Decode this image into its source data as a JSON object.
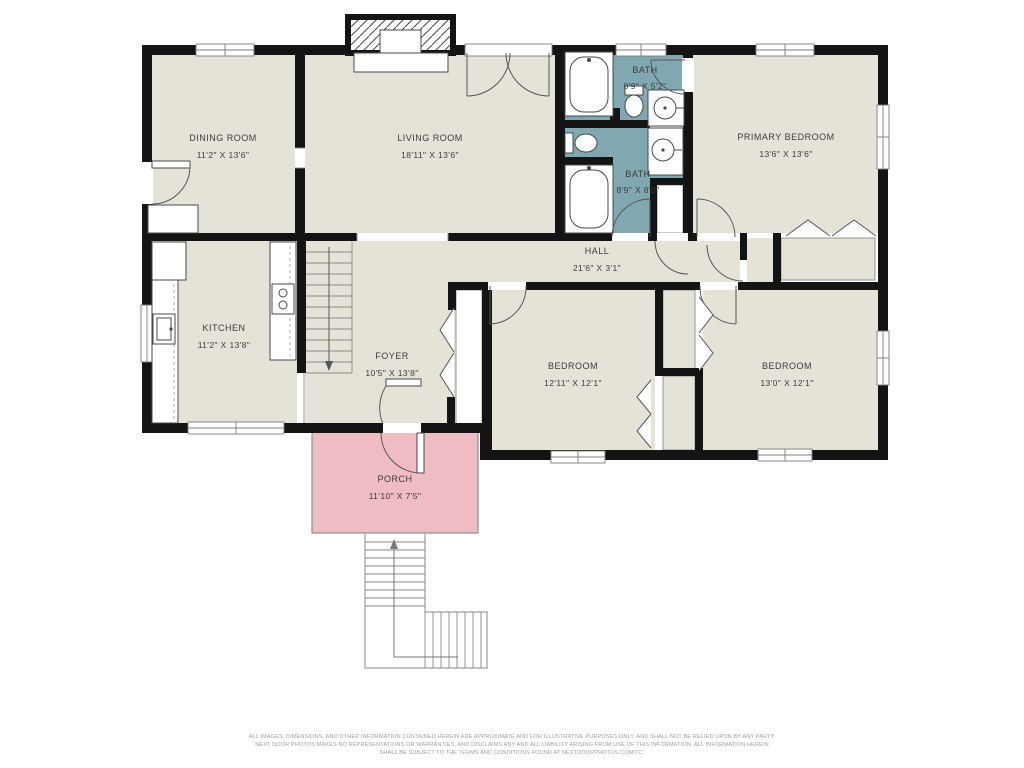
{
  "title": "single-story house floor plan",
  "colors": {
    "wall": "#141414",
    "floor": "#e5e3d7",
    "bath": "#7fa8b0",
    "porch": "#eebcc2",
    "background": "#ffffff",
    "text": "#3b3b3b",
    "disclaimer": "#a0a0a0"
  },
  "rooms": {
    "dining": {
      "name": "DINING ROOM",
      "dims": "11'2\" X 13'6\""
    },
    "living": {
      "name": "LIVING ROOM",
      "dims": "18'11\" X 13'6\""
    },
    "bath_top": {
      "name": "BATH",
      "dims": "8'9\" X 5'2\""
    },
    "bath_main": {
      "name": "BATH",
      "dims": "8'9\" X 8'0\""
    },
    "primary": {
      "name": "PRIMARY BEDROOM",
      "dims": "13'6\" X 13'6\""
    },
    "hall": {
      "name": "HALL",
      "dims": "21'6\" X 3'1\""
    },
    "kitchen": {
      "name": "KITCHEN",
      "dims": "11'2\" X 13'8\""
    },
    "foyer": {
      "name": "FOYER",
      "dims": "10'5\" X 13'8\""
    },
    "bedroom_left": {
      "name": "BEDROOM",
      "dims": "12'11\" X 12'1\""
    },
    "bedroom_right": {
      "name": "BEDROOM",
      "dims": "13'0\" X 12'1\""
    },
    "porch": {
      "name": "PORCH",
      "dims": "11'10\" X 7'5\""
    }
  },
  "disclaimer": {
    "line1": "ALL IMAGES, DIMENSIONS, AND OTHER INFORMATION CONTAINED HEREIN ARE APPROXIMATE AND FOR ILLUSTRATIVE PURPOSES ONLY, AND SHALL NOT BE RELIED UPON BY ANY PARTY.",
    "line2": "NEXT DOOR PHOTOS MAKES NO REPRESENTATIONS OR WARRANTIES, AND DISCLAIMS ANY AND ALL LIABILITY ARISING FROM USE OF THIS INFORMATION. ALL INFORMATION HEREIN",
    "line3": "SHALL BE SUBJECT TO THE TERMS AND CONDITIONS FOUND AT NEXTDOORPHOTOS.COM/TC."
  }
}
